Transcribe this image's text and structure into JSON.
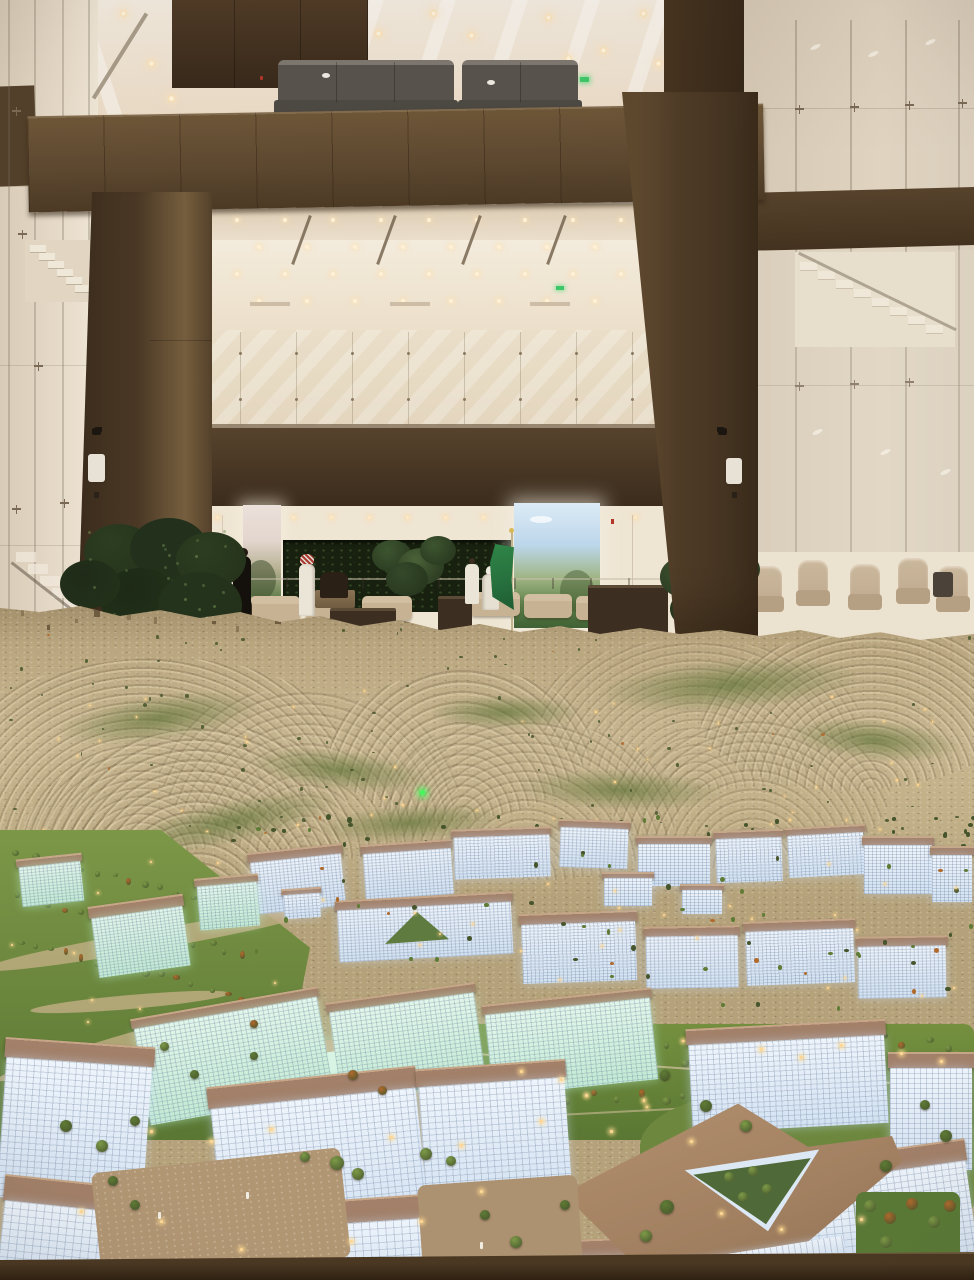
{
  "scene": {
    "description": "Exhibition atrium with glass walls and bronze-panelled portal overlooking a giant illuminated city masterplan scale model",
    "areas": {
      "atrium": "warm white ceiling with recessed downlights, bronze panel parapet and columns, glass curtain walls with spider fittings and staircases",
      "lobby": "reception lounge with landscape display screens, dark planted wall, beige sofas, stone planters, indoor plants",
      "model": "tan desert terrain with crescent-shaped residential streets, green park corridors, and clusters of glowing white and mint office buildings with tan roofs"
    },
    "entities": {
      "flag": "saudi-arabia-flag",
      "people": [
        "guard-in-black",
        "man-in-white-thobe-red-ghutra",
        "seated-attendant",
        "visitor-in-white",
        "visitor-in-white-ghutra"
      ],
      "screens": [
        "left-landscape-screen",
        "right-landscape-screen"
      ],
      "signs": [
        "exit-sign-balcony",
        "exit-sign-mezzanine-left",
        "exit-sign-mezzanine-right"
      ],
      "model_features": [
        "residential-crescents",
        "office-district",
        "campus-park",
        "triangle-courtyard-building",
        "green-laser-dot",
        "street-lamps"
      ]
    },
    "counts": {
      "balcony_sofa_groups": 2,
      "lounge_chairs_right": 5,
      "mid_distance_buildings": 20,
      "foreground_buildings": 15,
      "display_screens": 2
    }
  },
  "palette": {
    "ceilingHi": "#f6efe3",
    "ceilingLo": "#e9d8c2",
    "lightWarm": "#ffdfae",
    "beamHi": "#6e5638",
    "beamLo": "#4c3a25",
    "brownDark": "#3a2b1b",
    "panelBrown": "#54412c",
    "columnHi": "#77603f",
    "columnLo": "#3f2f1e",
    "fasciaHi": "#57432d",
    "fasciaLo": "#392a1b",
    "wallWhite": "#efe5d3",
    "glassTint": "#e0d4c1",
    "glassLine": "#8d7c64",
    "screenSkyL": "#e3d6cf",
    "screenGreenL": "#5f7c49",
    "screenSkyR": "#bcd6ea",
    "screenGreenR": "#5d8049",
    "darkWallGreen": "#18210f",
    "flagGreen": "#2f8648",
    "flagGreenDark": "#1e5c31",
    "poleTan": "#c4b48e",
    "sofaBeige": "#c7b294",
    "planterDark": "#3c2f21",
    "plantDark": "#24321b",
    "plantMid": "#3d5530",
    "skinTan": "#c9bfae",
    "thobeWhite": "#ebe5d8",
    "ghutraRed": "#a83c32",
    "guardBlack": "#14100b",
    "chairBeige": "#b89f80",
    "floorCream": "#ece1cd",
    "terrainHi": "#c8b690",
    "terrainMid": "#b9a67f",
    "terrainLo": "#a08c68",
    "crescentLight": "#e0d1ac",
    "crescentDark": "#7a684a",
    "vegGreen": "#5f7338",
    "treeDark": "#46552c",
    "treeMid": "#5f7b35",
    "treeLight": "#7d9a47",
    "treeAutumn": "#b06a2c",
    "lawnHi": "#7d9748",
    "lawnLo": "#5a7733",
    "roofTan": "#a28069",
    "roofLight": "#c6a687",
    "glowHi": "#eef4fb",
    "glowLo": "#d3e2f2",
    "mintHi": "#e2f6ea",
    "mintLo": "#c2ead4",
    "lampGlow": "#ffd794",
    "laserGreen": "#47f75c",
    "plazaTan": "#b19674",
    "baseBrown": "#3a2b18",
    "exitGreen": "#3ec768",
    "alarmRed": "#b2372a",
    "sofaGray": "#57534d",
    "sofaGrayHi": "#7d7870"
  }
}
